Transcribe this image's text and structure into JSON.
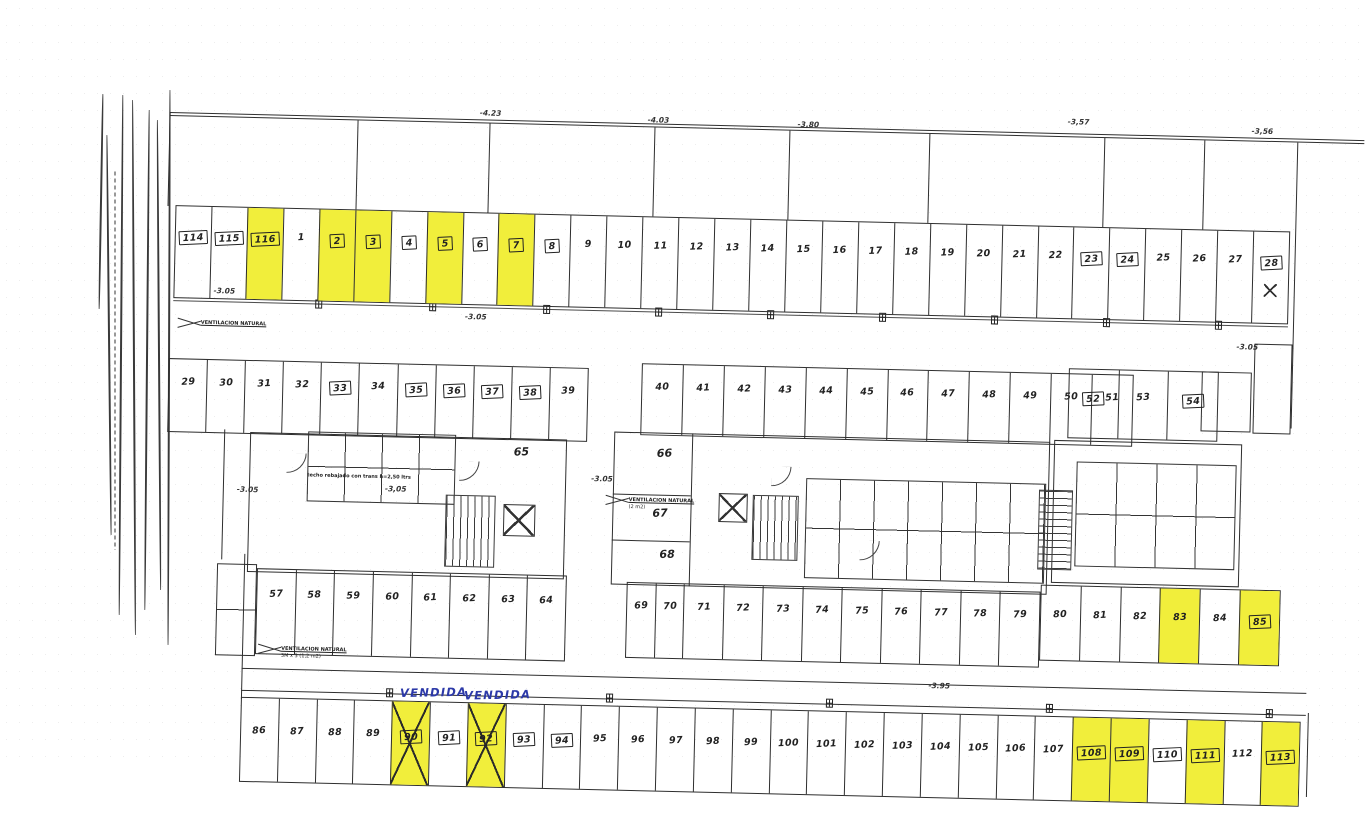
{
  "document": {
    "kind": "scanned parking garage floor plan"
  },
  "colors": {
    "line": "#2e2e2e",
    "highlight_yellow": "#f1ee3b",
    "handwriting_blue": "#2c39a8",
    "paper": "#ffffff"
  },
  "rows": [
    {
      "name": "top-1-28",
      "x": 8,
      "y": 105,
      "w": 1115,
      "h": 93,
      "pad": 24,
      "cells": [
        {
          "label": "114",
          "boxed": true
        },
        {
          "label": "115",
          "boxed": true
        },
        {
          "label": "116",
          "boxed": true,
          "yellow": true
        },
        {
          "label": "1"
        },
        {
          "label": "2",
          "boxed": true,
          "yellow": true
        },
        {
          "label": "3",
          "boxed": true,
          "yellow": true
        },
        {
          "label": "4",
          "boxed": true
        },
        {
          "label": "5",
          "boxed": true,
          "yellow": true
        },
        {
          "label": "6",
          "boxed": true
        },
        {
          "label": "7",
          "boxed": true,
          "yellow": true
        },
        {
          "label": "8",
          "boxed": true
        },
        {
          "label": "9"
        },
        {
          "label": "10"
        },
        {
          "label": "11"
        },
        {
          "label": "12"
        },
        {
          "label": "13"
        },
        {
          "label": "14"
        },
        {
          "label": "15"
        },
        {
          "label": "16"
        },
        {
          "label": "17"
        },
        {
          "label": "18"
        },
        {
          "label": "19"
        },
        {
          "label": "20"
        },
        {
          "label": "21"
        },
        {
          "label": "22"
        },
        {
          "label": "23",
          "boxed": true
        },
        {
          "label": "24",
          "boxed": true
        },
        {
          "label": "25"
        },
        {
          "label": "26"
        },
        {
          "label": "27"
        },
        {
          "label": "28",
          "boxed": true
        }
      ]
    },
    {
      "name": "29-39",
      "x": 5,
      "y": 258,
      "w": 420,
      "h": 74,
      "pad": 18,
      "cells": [
        {
          "label": "29"
        },
        {
          "label": "30"
        },
        {
          "label": "31"
        },
        {
          "label": "32"
        },
        {
          "label": "33",
          "boxed": true
        },
        {
          "label": "34"
        },
        {
          "label": "35",
          "boxed": true
        },
        {
          "label": "36",
          "boxed": true
        },
        {
          "label": "37",
          "boxed": true
        },
        {
          "label": "38",
          "boxed": true
        },
        {
          "label": "39"
        }
      ]
    },
    {
      "name": "40-51",
      "x": 478,
      "y": 252,
      "w": 492,
      "h": 72,
      "pad": 18,
      "cells": [
        {
          "label": "40"
        },
        {
          "label": "41"
        },
        {
          "label": "42"
        },
        {
          "label": "43"
        },
        {
          "label": "44"
        },
        {
          "label": "45"
        },
        {
          "label": "46"
        },
        {
          "label": "47"
        },
        {
          "label": "48"
        },
        {
          "label": "49"
        },
        {
          "label": "50"
        },
        {
          "label": "51"
        }
      ]
    },
    {
      "name": "52-54",
      "x": 905,
      "y": 247,
      "w": 150,
      "h": 70,
      "pad": 22,
      "cells": [
        {
          "label": "52",
          "boxed": true
        },
        {
          "label": "53"
        },
        {
          "label": "54",
          "boxed": true
        }
      ]
    },
    {
      "name": "57-64",
      "x": 98,
      "y": 466,
      "w": 310,
      "h": 86,
      "pad": 20,
      "cells": [
        {
          "label": "57"
        },
        {
          "label": "58"
        },
        {
          "label": "59"
        },
        {
          "label": "60"
        },
        {
          "label": "61"
        },
        {
          "label": "62"
        },
        {
          "label": "63"
        },
        {
          "label": "64"
        }
      ]
    },
    {
      "name": "69-79",
      "x": 468,
      "y": 471,
      "w": 414,
      "h": 76,
      "pad": 18,
      "cells": [
        {
          "label": "69",
          "wf": 0.72
        },
        {
          "label": "70",
          "wf": 0.72
        },
        {
          "label": "71"
        },
        {
          "label": "72"
        },
        {
          "label": "73"
        },
        {
          "label": "74"
        },
        {
          "label": "75"
        },
        {
          "label": "76"
        },
        {
          "label": "77"
        },
        {
          "label": "78"
        },
        {
          "label": "79"
        }
      ]
    },
    {
      "name": "80-85",
      "x": 882,
      "y": 464,
      "w": 240,
      "h": 76,
      "pad": 24,
      "cells": [
        {
          "label": "80"
        },
        {
          "label": "81"
        },
        {
          "label": "82"
        },
        {
          "label": "83",
          "yellow": true
        },
        {
          "label": "84"
        },
        {
          "label": "85",
          "boxed": true,
          "yellow": true
        }
      ]
    },
    {
      "name": "bottom-86-113",
      "x": 85,
      "y": 595,
      "w": 1060,
      "h": 85,
      "pad": 28,
      "cells": [
        {
          "label": "86"
        },
        {
          "label": "87"
        },
        {
          "label": "88"
        },
        {
          "label": "89"
        },
        {
          "label": "90",
          "boxed": true,
          "yellow": true,
          "cross": true
        },
        {
          "label": "91",
          "boxed": true
        },
        {
          "label": "92",
          "boxed": true,
          "yellow": true,
          "cross": true
        },
        {
          "label": "93",
          "boxed": true
        },
        {
          "label": "94",
          "boxed": true
        },
        {
          "label": "95"
        },
        {
          "label": "96"
        },
        {
          "label": "97"
        },
        {
          "label": "98"
        },
        {
          "label": "99"
        },
        {
          "label": "100"
        },
        {
          "label": "101"
        },
        {
          "label": "102"
        },
        {
          "label": "103"
        },
        {
          "label": "104"
        },
        {
          "label": "105"
        },
        {
          "label": "106"
        },
        {
          "label": "107"
        },
        {
          "label": "108",
          "boxed": true,
          "yellow": true
        },
        {
          "label": "109",
          "boxed": true,
          "yellow": true
        },
        {
          "label": "110",
          "boxed": true
        },
        {
          "label": "111",
          "boxed": true,
          "yellow": true
        },
        {
          "label": "112"
        },
        {
          "label": "113",
          "boxed": true,
          "yellow": true
        }
      ]
    }
  ],
  "annotations": [
    {
      "cls": "elev",
      "name": "elevation-label",
      "text": "-4.23",
      "x": 310,
      "y": 2
    },
    {
      "cls": "elev",
      "name": "elevation-label",
      "text": "-4.03",
      "x": 478,
      "y": 5
    },
    {
      "cls": "elev",
      "name": "elevation-label",
      "text": "-3,80",
      "x": 628,
      "y": 6
    },
    {
      "cls": "elev",
      "name": "elevation-label",
      "text": "-3,57",
      "x": 898,
      "y": -3
    },
    {
      "cls": "elev",
      "name": "elevation-label",
      "text": "-3,56",
      "x": 1082,
      "y": 2
    },
    {
      "cls": "elev",
      "name": "elevation-label",
      "text": "-3.05",
      "x": 48,
      "y": 186
    },
    {
      "cls": "elev",
      "name": "elevation-label",
      "text": "-3.05",
      "x": 300,
      "y": 206
    },
    {
      "cls": "elev",
      "name": "elevation-label",
      "text": "-3.05",
      "x": 1072,
      "y": 218
    },
    {
      "cls": "elev",
      "name": "elevation-label",
      "text": "-3.05",
      "x": 76,
      "y": 384
    },
    {
      "cls": "elev",
      "name": "elevation-label",
      "text": "-3.05",
      "x": 430,
      "y": 365
    },
    {
      "cls": "elev",
      "name": "elevation-label",
      "text": "-3,05",
      "x": 224,
      "y": 380
    },
    {
      "cls": "elev",
      "name": "elevation-label",
      "text": "-3.95",
      "x": 772,
      "y": 564
    },
    {
      "cls": "room",
      "name": "room-label-65",
      "text": "65",
      "x": 352,
      "y": 338
    },
    {
      "cls": "room",
      "name": "room-label-66",
      "text": "66",
      "x": 495,
      "y": 336
    },
    {
      "cls": "room",
      "name": "room-label-67",
      "text": "67",
      "x": 492,
      "y": 396
    },
    {
      "cls": "room",
      "name": "room-label-68",
      "text": "68",
      "x": 500,
      "y": 437
    },
    {
      "cls": "tiny vent",
      "name": "note-ventilation",
      "text": "VENTILACION NATURAL",
      "x": 36,
      "y": 219
    },
    {
      "cls": "tiny vent",
      "name": "note-ventilation",
      "text": "VENTILACION NATURAL",
      "sub": "3M x 3 (1,2 m2)",
      "x": 124,
      "y": 543
    },
    {
      "cls": "tiny vent",
      "name": "note-ventilation",
      "text": "VENTILACION NATURAL",
      "sub": "(2 m2)",
      "x": 468,
      "y": 386
    },
    {
      "cls": "tiny",
      "name": "note-ceiling",
      "text": "techo rebajado con trans h=2,50 ltrs",
      "x": 146,
      "y": 369
    },
    {
      "cls": "hand",
      "name": "handwritten-vendida",
      "text": "VENDIDA",
      "x": 244,
      "y": 581
    },
    {
      "cls": "hand",
      "name": "handwritten-vendida",
      "text": "VENDIDA",
      "x": 308,
      "y": 582
    }
  ]
}
